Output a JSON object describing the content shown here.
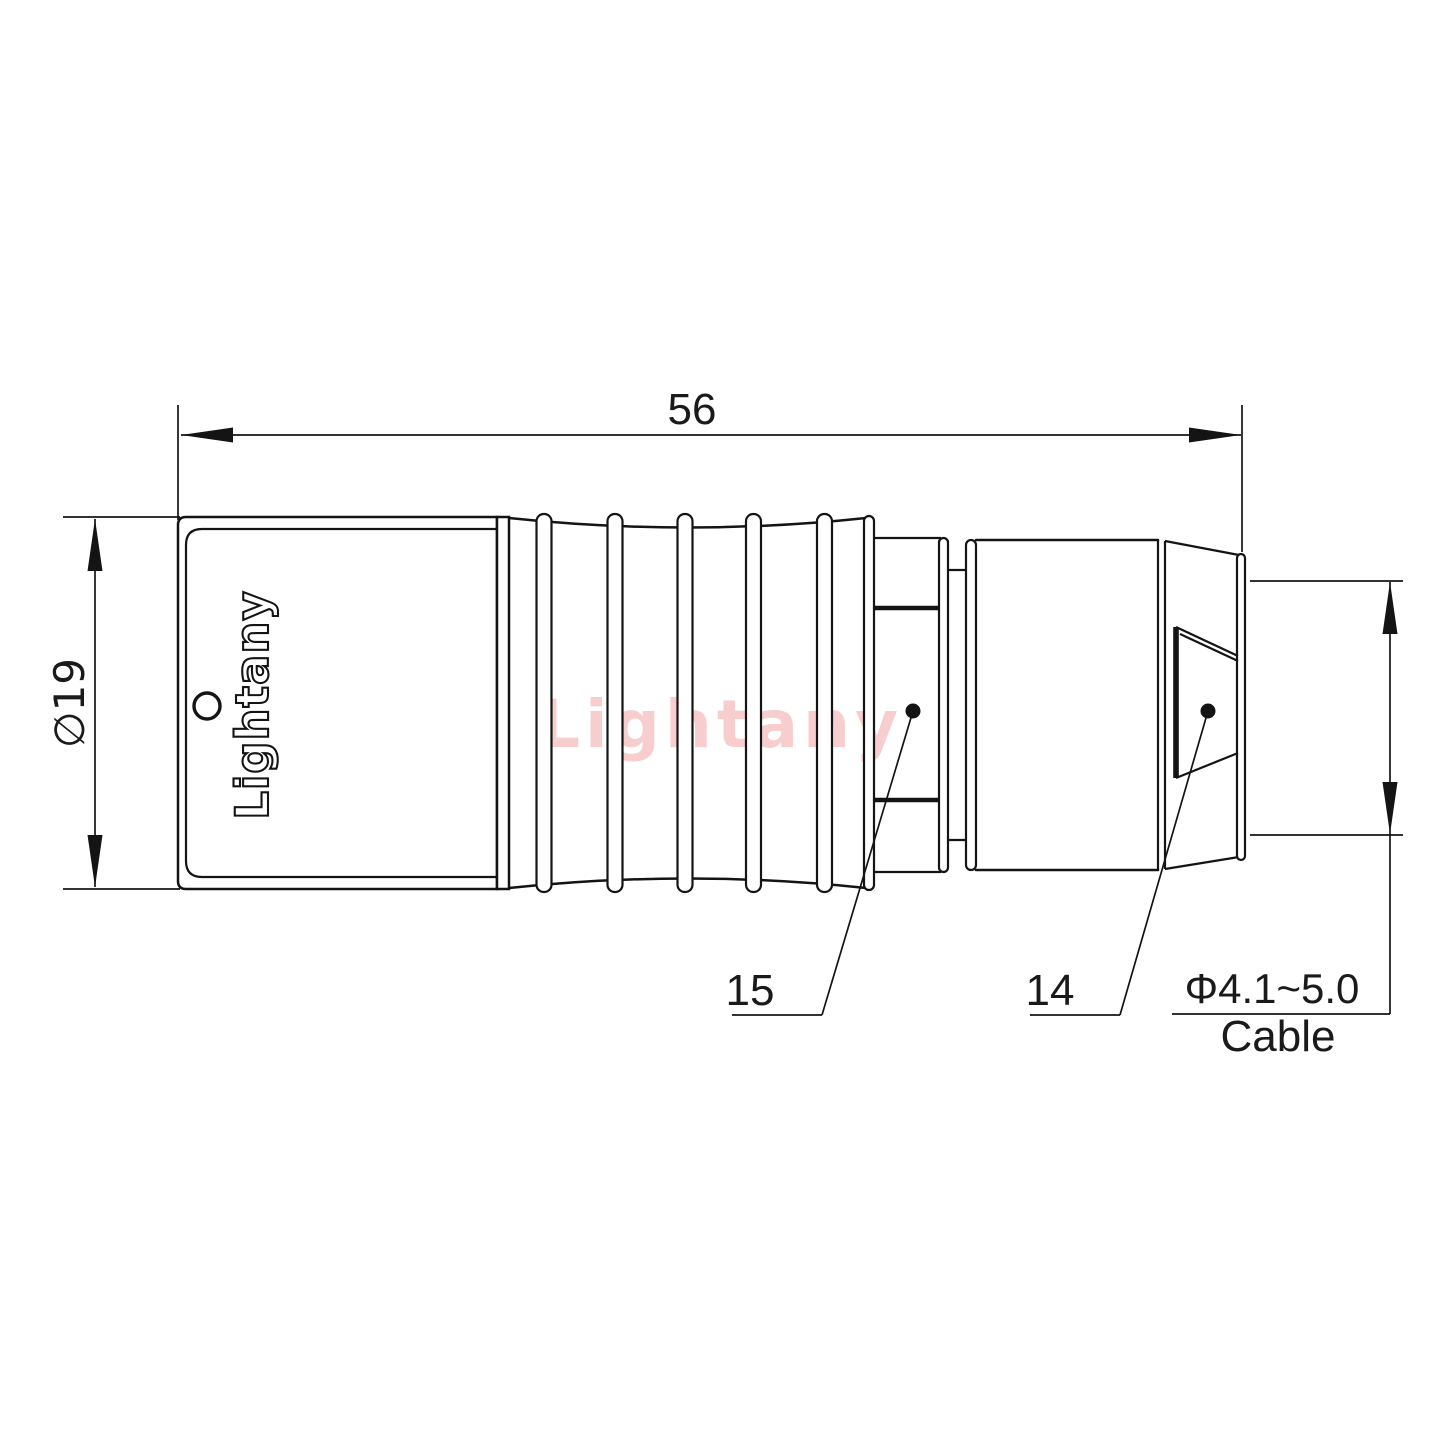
{
  "drawing": {
    "title": "push-pull circular connector straight plug side view",
    "watermark": "Lightany",
    "body_logo": "Lightany",
    "dimensions": {
      "overall_length": "56",
      "body_diameter": "∅19",
      "cable_range": "Φ4.1~5.0",
      "cable_label": "Cable"
    },
    "part_labels": {
      "grip_part": "15",
      "nut_part": "14"
    },
    "colors": {
      "line": "#141414",
      "watermark": "#f6c5c5",
      "background": "#ffffff"
    }
  }
}
